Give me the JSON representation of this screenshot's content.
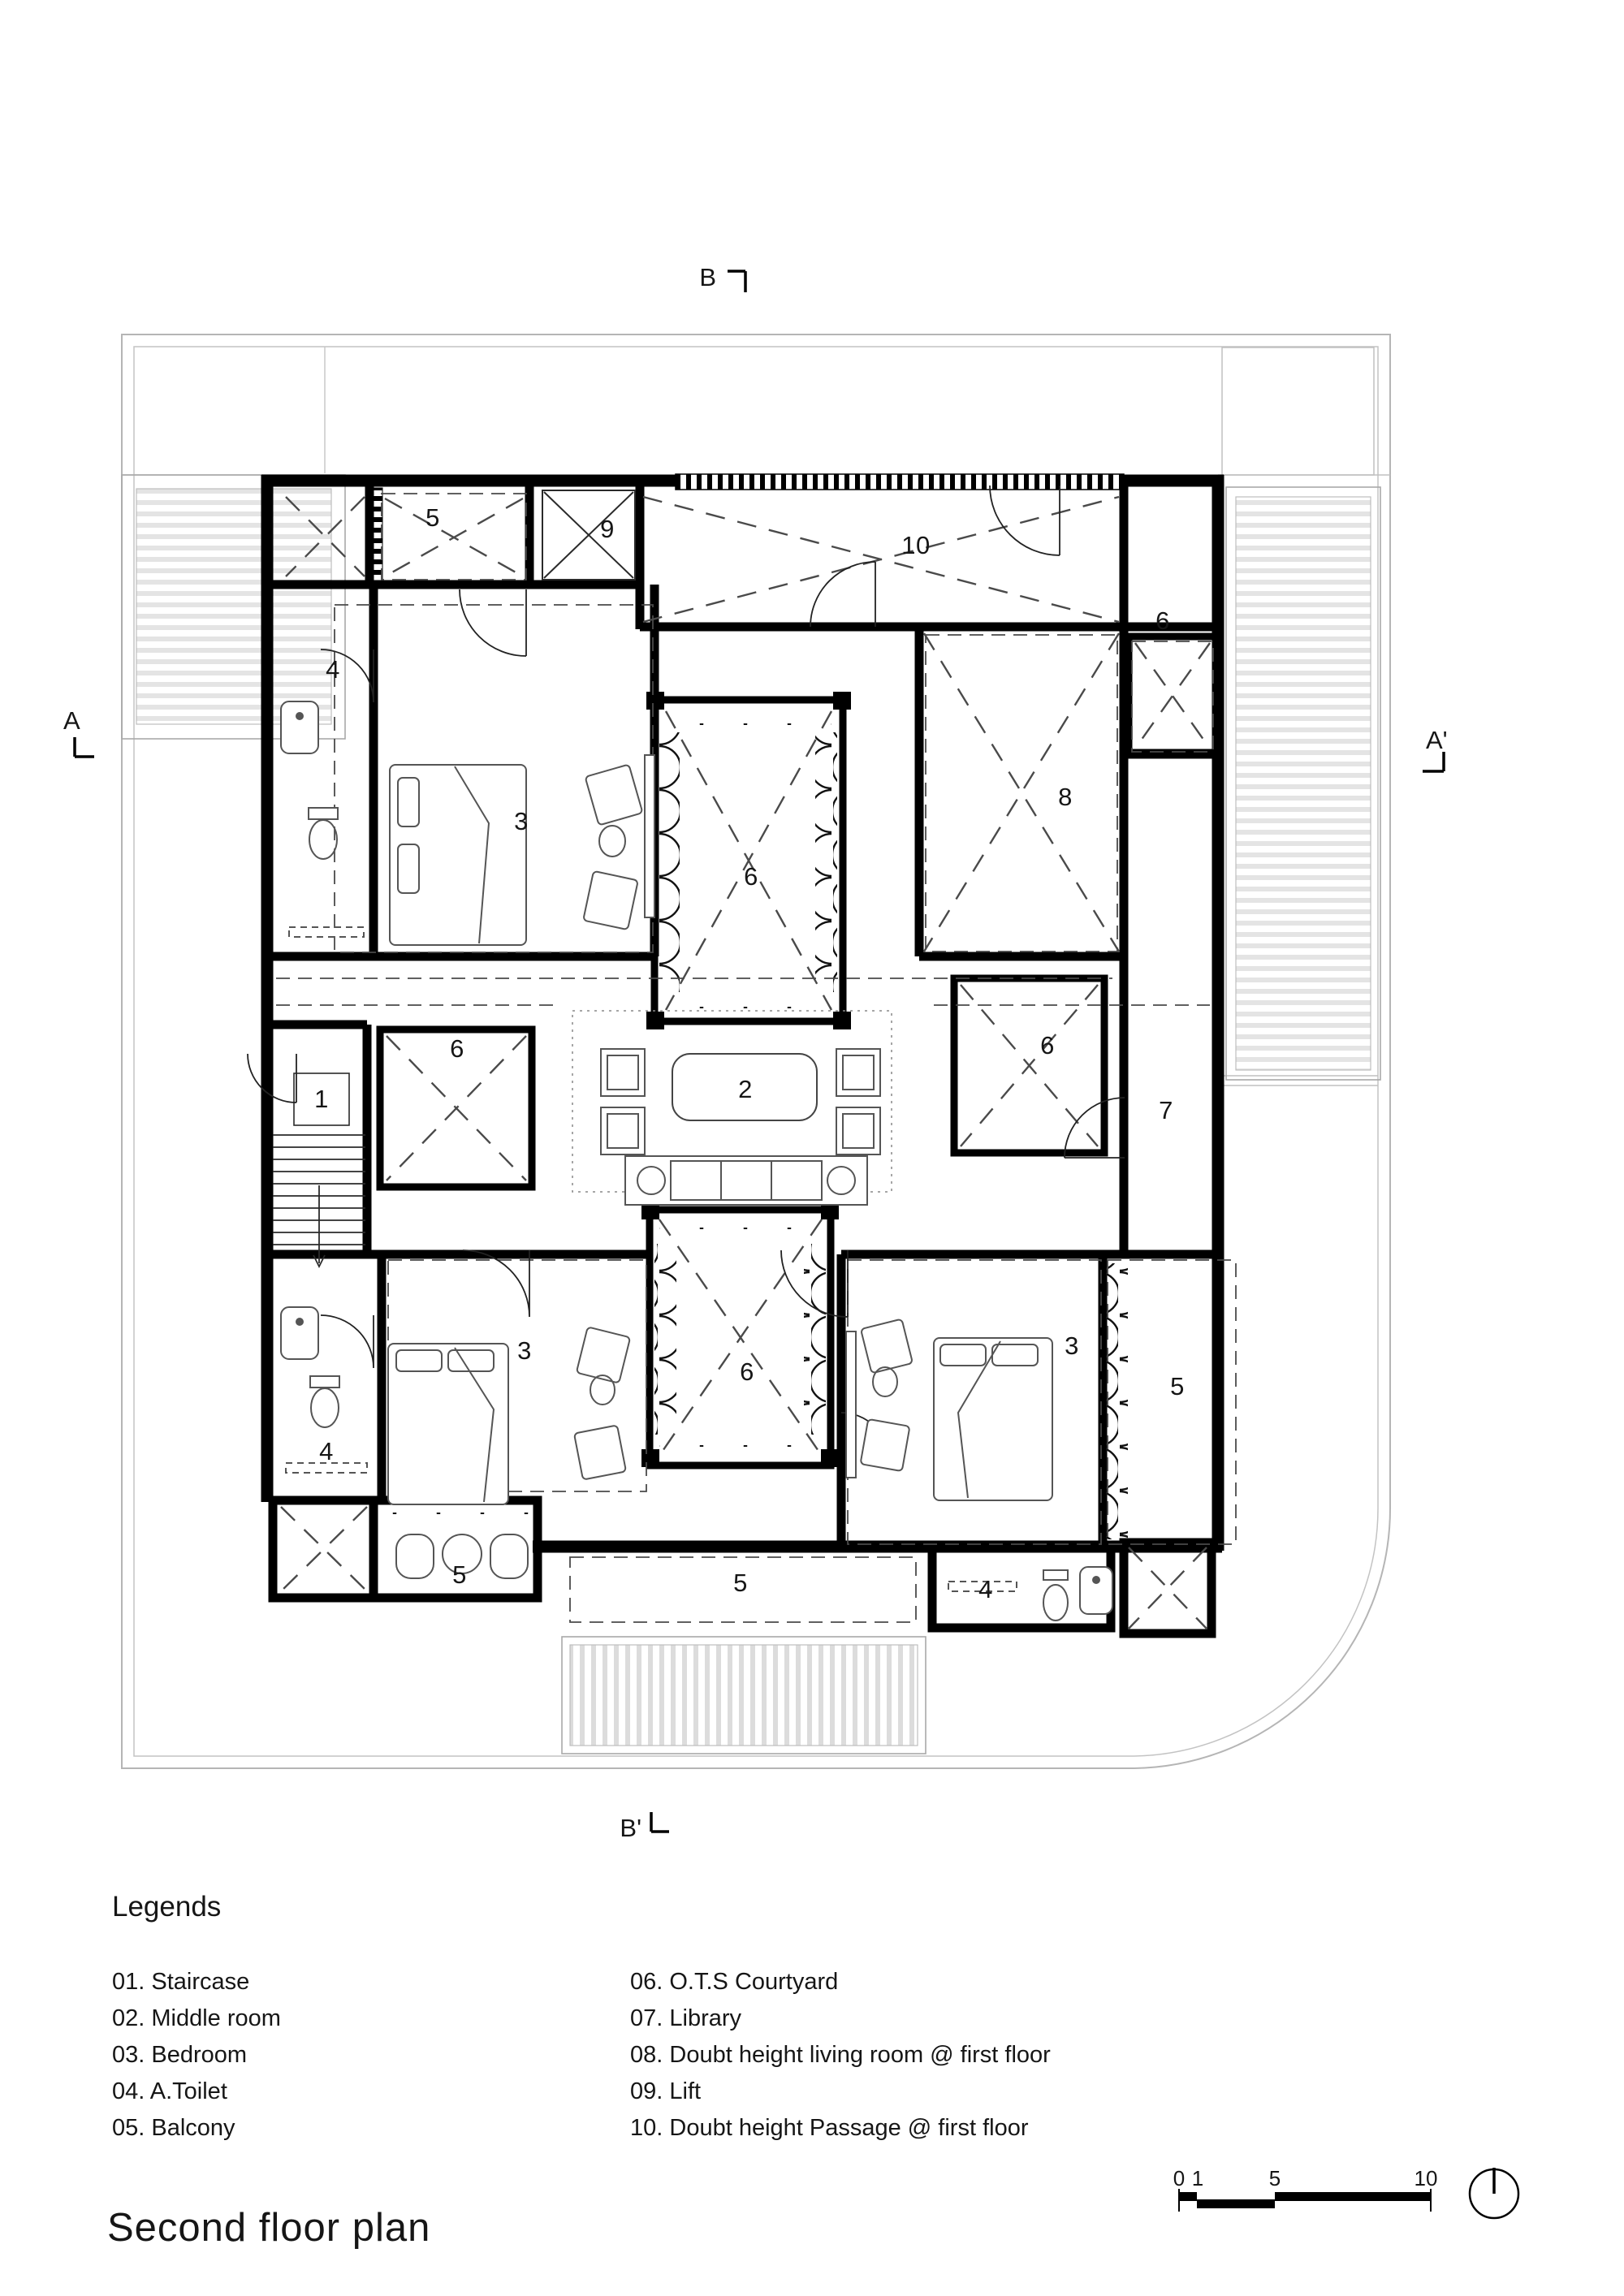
{
  "page": {
    "title": "Second floor plan"
  },
  "legend": {
    "heading": "Legends",
    "col1": [
      "01. Staircase",
      "02. Middle room",
      "03. Bedroom",
      "04. A.Toilet",
      "05. Balcony"
    ],
    "col2": [
      "06. O.T.S Courtyard",
      "07. Library",
      "08. Doubt height living room @ first floor",
      "09. Lift",
      "10. Doubt height Passage @ first floor"
    ]
  },
  "markers": {
    "top": "B",
    "bottom": "B'",
    "left": "A",
    "right": "A'"
  },
  "scale_bar": {
    "ticks": [
      "0",
      "1",
      "5",
      "10"
    ]
  },
  "room_labels": {
    "staircase": "1",
    "middle_room": "2",
    "bedroom_top": "3",
    "bedroom_bottom_left": "3",
    "bedroom_bottom_right": "3",
    "toilet_top_left": "4",
    "toilet_bottom_left": "4",
    "toilet_bottom_right": "4",
    "balcony_top": "5",
    "balcony_right": "5",
    "balcony_small_bottom": "5",
    "balcony_bottom_center": "5",
    "courtyard_top_right": "6",
    "courtyard_upper": "6",
    "courtyard_left": "6",
    "courtyard_right": "6",
    "courtyard_lower": "6",
    "library": "7",
    "living_room": "8",
    "lift": "9",
    "passage": "10"
  },
  "colors": {
    "wall": "#000000",
    "thin_line": "#2a2a2a",
    "dashed_line": "#4a4a4a",
    "property_line": "#b5b5b5",
    "hatch_stripe": "#e2e2e2",
    "background": "#ffffff"
  }
}
